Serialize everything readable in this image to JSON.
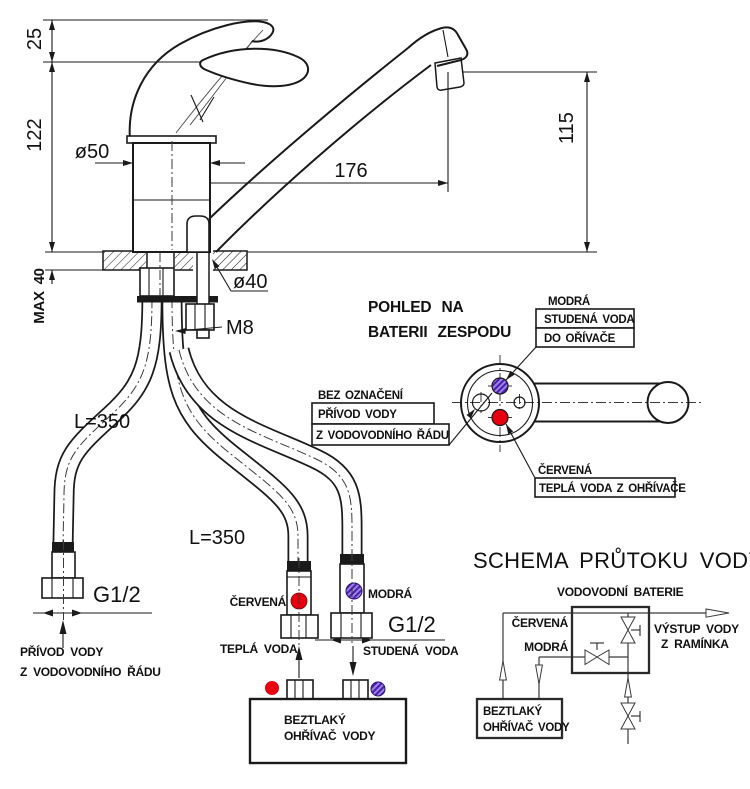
{
  "drawing": {
    "dims": {
      "d25": "25",
      "d122": "122",
      "d115": "115",
      "d176": "176",
      "dia50": "ø50",
      "dia40": "ø40",
      "max40": "MAX 40",
      "m8": "M8",
      "l350_a": "L=350",
      "l350_b": "L=350",
      "g12_a": "G1/2",
      "g12_b": "G1/2"
    },
    "labels": {
      "supply1": "PŘÍVOD VODY",
      "supply2": "Z VODOVODNÍHO ŘÁDU",
      "red": "ČERVENÁ",
      "hot": "TEPLÁ VODA",
      "blue": "MODRÁ",
      "cold": "STUDENÁ VODA"
    },
    "heater": {
      "l1": "BEZTLAKÝ",
      "l2": "OHŘÍVAČ VODY"
    }
  },
  "bottom_view": {
    "title1": "POHLED NA",
    "title2": "BATERII ZESPODU",
    "blue": "MODRÁ",
    "blue_box1": "STUDENÁ VODA",
    "blue_box2": "DO OŘÍVAČE",
    "plain": "BEZ OZNAČENÍ",
    "plain_box1": "PŘÍVOD VODY",
    "plain_box2": "Z VODOVODNÍHO ŘÁDU",
    "red": "ČERVENÁ",
    "red_box": "TEPLÁ VODA Z OHŘÍVAČE"
  },
  "schema": {
    "title": "SCHEMA PRŮTOKU VODY",
    "battery": "VODOVODNÍ BATERIE",
    "red": "ČERVENÁ",
    "blue": "MODRÁ",
    "out1": "VÝSTUP VODY",
    "out2": "Z RAMÍNKA",
    "heater1": "BEZTLAKÝ",
    "heater2": "OHŘÍVAČ VODY"
  },
  "colors": {
    "red": "#e8000f",
    "violet": "#5b2db8",
    "violet_light": "#9b82e4",
    "line": "#1a1a1a",
    "background": "#ffffff"
  }
}
